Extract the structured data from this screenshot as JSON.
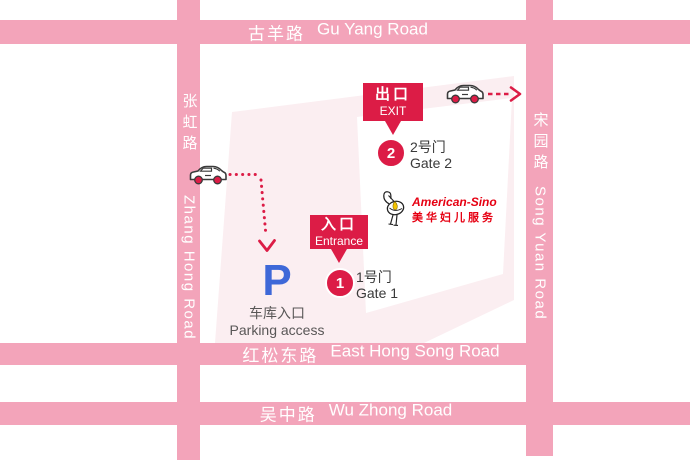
{
  "roads": {
    "gu_yang": {
      "zh": "古羊路",
      "en": "Gu Yang Road"
    },
    "zhang_hong": {
      "zh": "张虹路",
      "en": "Zhang Hong Road"
    },
    "song_yuan": {
      "zh": "宋园路",
      "en": "Song Yuan Road"
    },
    "east_hong_song": {
      "zh": "红松东路",
      "en": "East Hong Song Road"
    },
    "wu_zhong": {
      "zh": "吴中路",
      "en": "Wu Zhong Road"
    }
  },
  "callouts": {
    "exit": {
      "zh": "出口",
      "en": "EXIT"
    },
    "entrance": {
      "zh": "入口",
      "en": "Entrance"
    }
  },
  "gates": {
    "gate2": {
      "number": "2",
      "zh": "2号门",
      "en": "Gate 2"
    },
    "gate1": {
      "number": "1",
      "zh": "1号门",
      "en": "Gate 1"
    }
  },
  "parking": {
    "symbol": "P",
    "zh": "车库入口",
    "en": "Parking access"
  },
  "logo": {
    "en": "American-Sino",
    "zh": "美华妇儿服务"
  },
  "colors": {
    "road_pink": "#F3A4BA",
    "block_pale_pink": "#FBEEF1",
    "accent_red": "#DC1C46",
    "logo_red": "#E60012",
    "parking_blue": "#3E68D8",
    "text_dark": "#3A3A3A",
    "text_gray": "#595757",
    "road_text": "#FFFFFF"
  }
}
